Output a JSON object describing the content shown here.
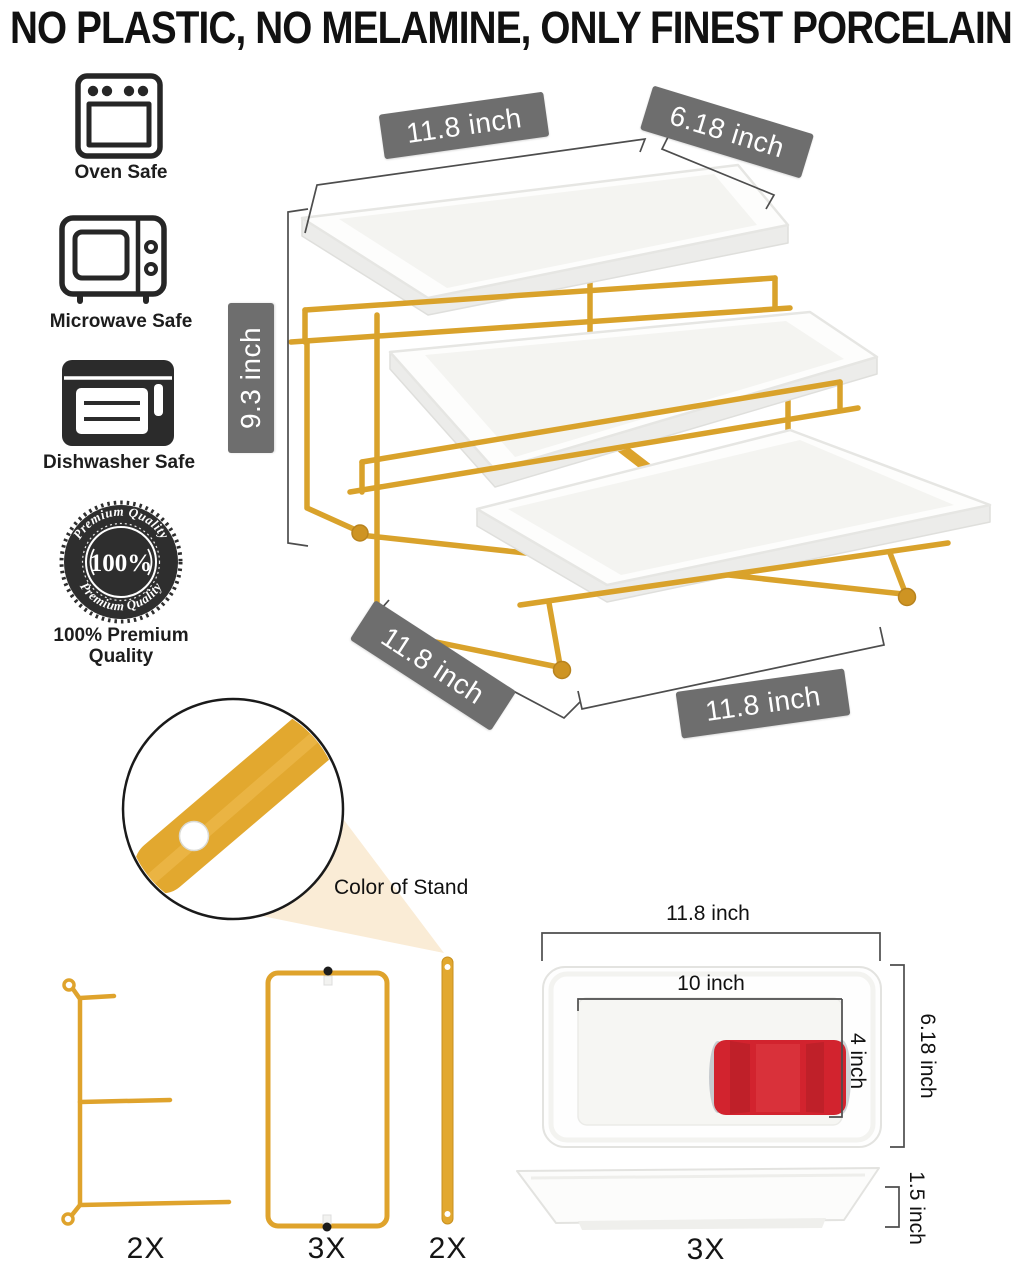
{
  "headline": "NO PLASTIC, NO MELAMINE, ONLY FINEST PORCELAIN",
  "features": {
    "oven": "Oven Safe",
    "microwave": "Microwave Safe",
    "dishwasher": "Dishwasher Safe",
    "premium": "100% Premium Quality"
  },
  "premium_badge": {
    "arc_top": "Premium Quality",
    "arc_bottom": "Premium Quality",
    "center": "100%"
  },
  "main_dimensions": {
    "top_length": "11.8 inch",
    "top_depth": "6.18 inch",
    "height": "9.3 inch",
    "base_depth": "11.8 inch",
    "base_length": "11.8 inch"
  },
  "callout": {
    "stand_color": "Color of Stand"
  },
  "parts": {
    "side_frame_qty": "2X",
    "rect_frame_qty": "3X",
    "flat_bar_qty": "2X"
  },
  "plate_detail": {
    "outer_length": "11.8 inch",
    "inner_length": "10 inch",
    "inner_width": "4 inch",
    "outer_width": "6.18 inch",
    "height": "1.5 inch",
    "qty": "3X"
  },
  "colors": {
    "gold": "#DCA32C",
    "badge_gray": "#6E6E6E",
    "can_red": "#D2232E",
    "beam_cream": "#FAECD6"
  }
}
